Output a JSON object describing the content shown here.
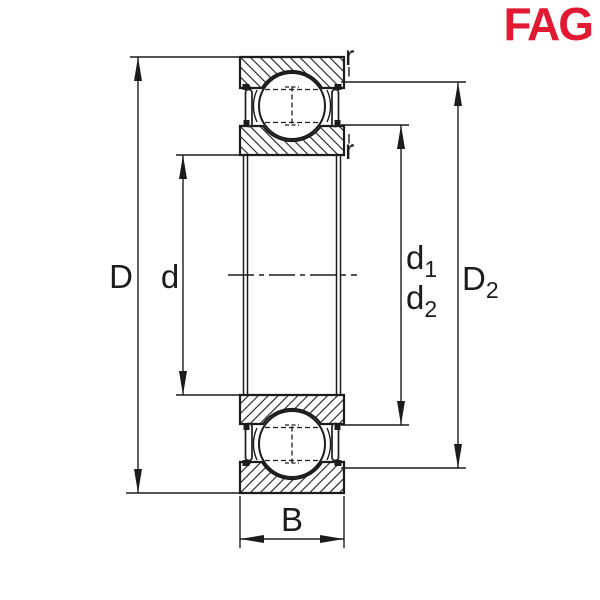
{
  "logo": {
    "text": "FAG",
    "color": "#e11932"
  },
  "diagram": {
    "type": "bearing-cross-section-dimension-drawing",
    "colors": {
      "line": "#1c1c1c",
      "background": "#ffffff",
      "logo_red": "#e11932"
    },
    "labels": {
      "outer_diameter": "D",
      "bore_diameter": "d",
      "d1_base": "d",
      "d1_sub": "1",
      "d2_base": "d",
      "d2_sub": "2",
      "D2_base": "D",
      "D2_sub": "2",
      "width": "B",
      "r_top": "r",
      "r_bottom": "r"
    }
  }
}
